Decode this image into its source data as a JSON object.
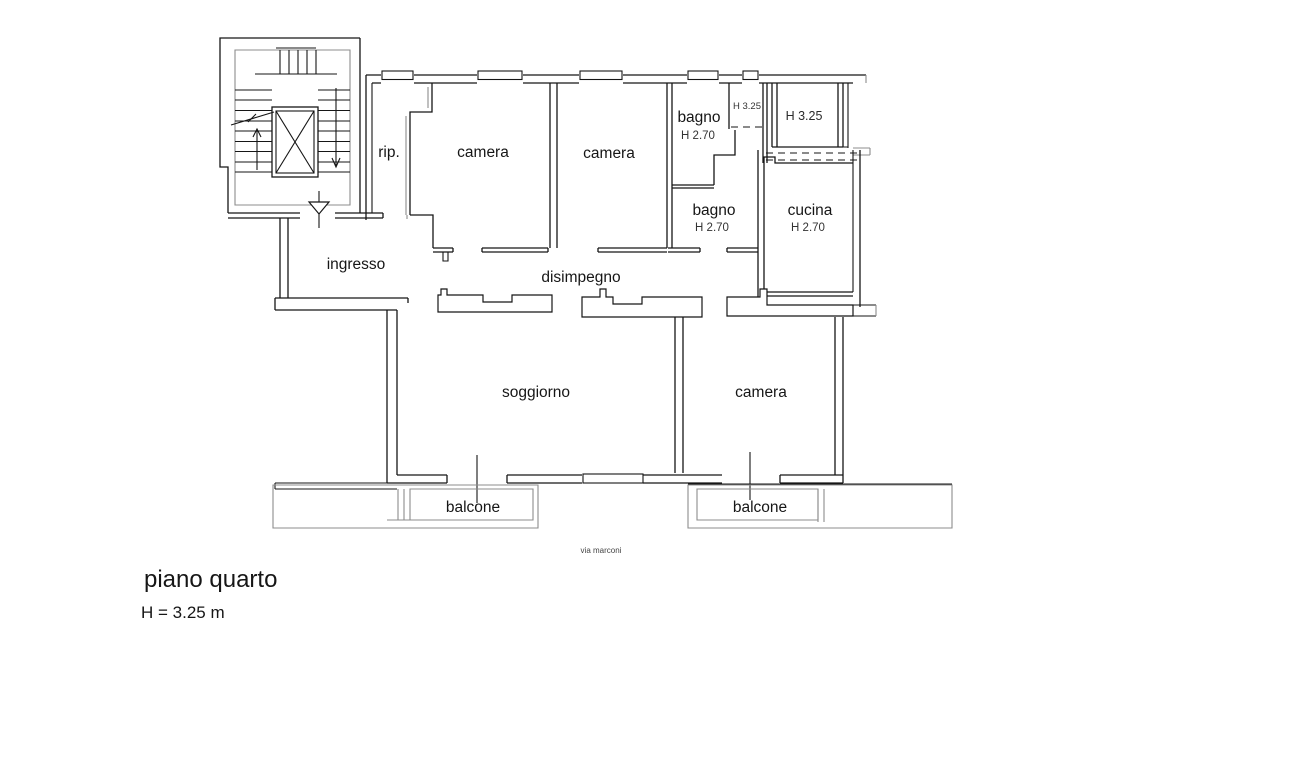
{
  "plan": {
    "rooms": {
      "storage": "rip.",
      "bedroom_1": "camera",
      "bedroom_2": "camera",
      "bedroom_3": "camera",
      "bathroom_1": "bagno",
      "bathroom_1_height": "H 2.70",
      "bathroom_2": "bagno",
      "bathroom_2_height": "H 2.70",
      "kitchen": "cucina",
      "kitchen_height": "H 2.70",
      "entry": "ingresso",
      "hallway": "disimpegno",
      "living_room": "soggiorno",
      "balcony_1": "balcone",
      "balcony_2": "balcone",
      "shaft_height": "H 3.25",
      "veranda_height": "H 3.25"
    },
    "street_label": "via marconi",
    "footer": {
      "floor_label": "piano quarto",
      "ceiling_height": "H = 3.25 m"
    },
    "colors": {
      "wall": "#161616",
      "secondary_lines": "#8c8c8c",
      "background": "#ffffff"
    }
  }
}
